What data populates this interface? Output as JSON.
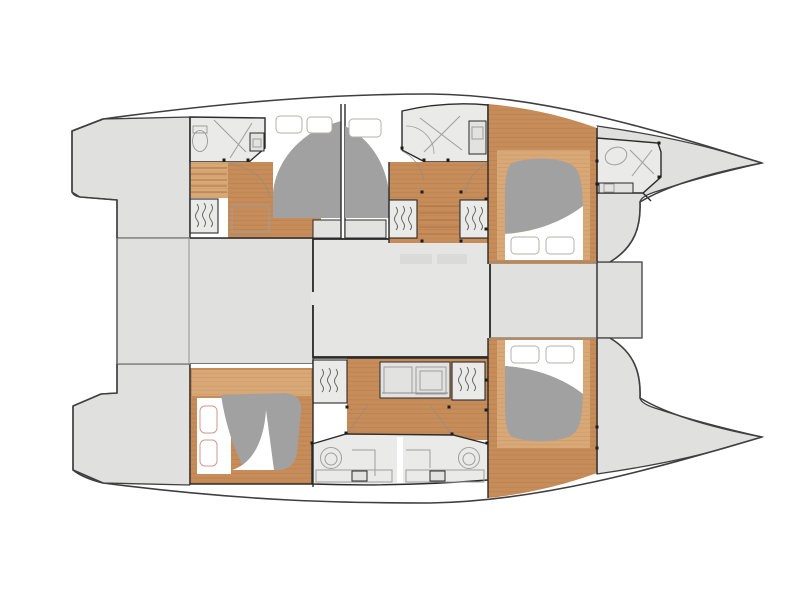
{
  "figure": {
    "type": "floor-plan",
    "subject": "Sailing catamaran accommodation deck plan, top-down view, bows pointing right",
    "orientation": "bow-right",
    "cabin_count": 4,
    "bathroom_count": 5,
    "double_berth_count": 4,
    "wardrobe_count": 5
  },
  "colors": {
    "white": "#ffffff",
    "deck": "#e0e0df",
    "saloon": "#e5e5e4",
    "room": "#eaeae9",
    "counter": "#e2e2e1",
    "faint": "#dadad9",
    "wood": "#c68c59",
    "plank": "#b07545",
    "wood_light": "#d8a877",
    "plank_light": "#c48e57",
    "bed": "#a1a1a1",
    "pillow": "#ffffff",
    "pillow_stroke": "#b5b0ab",
    "pillow_stroke_accent": "#cf9a8e",
    "outline": "#3f3f3f",
    "wall": "#2b2b2b",
    "line": "#8c8c8c",
    "fixture": "#9e9e9e",
    "hanger": "#5a5a5a",
    "dot": "#1c1c1c"
  },
  "rooms": {
    "plan": "Catamaran deck plan",
    "cockpit": "Aft cockpit",
    "saloon": "Saloon",
    "foredeck": "Foredeck",
    "transom_port": "Port transom platform",
    "transom_starboard": "Starboard transom platform",
    "bow_port": "Port bow deck",
    "bow_starboard": "Starboard bow deck",
    "aft_head_port": "Port aft bathroom",
    "mid_head_port": "Port forward bathroom",
    "bow_head_port": "Port bow day head",
    "aft_cabin_port": "Port aft cabin",
    "mid_cabin_port": "Port midship cabin",
    "fwd_cabin_port": "Port forward cabin",
    "aft_cabin_starboard": "Starboard aft cabin",
    "fwd_cabin_starboard": "Starboard forward cabin",
    "aft_head_starboard": "Starboard aft bathroom",
    "fwd_head_starboard": "Starboard forward bathroom",
    "galley_unit": "Galley unit",
    "stairs_aft": "Aft companionway steps",
    "stairs_mid": "Midship companionway steps",
    "wardrobe": "Hanging wardrobe",
    "berth": "Double berth"
  }
}
